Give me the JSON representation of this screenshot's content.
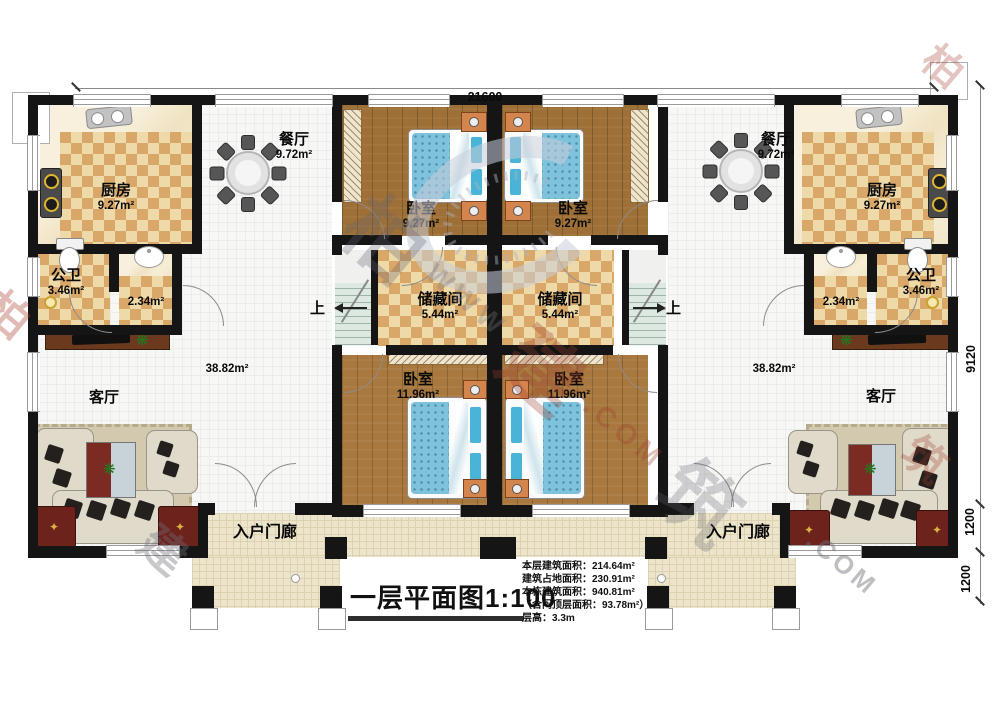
{
  "dims": {
    "top": "21600",
    "right_main": "9120",
    "right_mid": "1200",
    "right_low": "1200"
  },
  "stairs": {
    "up_left": "上",
    "up_right": "上"
  },
  "rooms": {
    "kitchen_left": {
      "name": "厨房",
      "area": "9.27m²"
    },
    "kitchen_right": {
      "name": "厨房",
      "area": "9.27m²"
    },
    "dining_left": {
      "name": "餐厅",
      "area": "9.72m²"
    },
    "dining_right": {
      "name": "餐厅",
      "area": "9.72m²"
    },
    "bath_left": {
      "name": "公卫",
      "area": "3.46m²"
    },
    "bath_right": {
      "name": "公卫",
      "area": "3.46m²"
    },
    "wash_left": {
      "area": "2.34m²"
    },
    "wash_right": {
      "area": "2.34m²"
    },
    "living_left": {
      "name": "客厅",
      "area": "38.82m²"
    },
    "living_right": {
      "name": "客厅",
      "area": "38.82m²"
    },
    "bedroom_top_left": {
      "name": "卧室",
      "area": "9.27m²"
    },
    "bedroom_top_right": {
      "name": "卧室",
      "area": "9.27m²"
    },
    "storage_left": {
      "name": "储藏间",
      "area": "5.44m²"
    },
    "storage_right": {
      "name": "储藏间",
      "area": "5.44m²"
    },
    "bedroom_bottom_left": {
      "name": "卧室",
      "area": "11.96m²"
    },
    "bedroom_bottom_right": {
      "name": "卧室",
      "area": "11.96m²"
    },
    "porch_left": {
      "name": "入户门廊"
    },
    "porch_right": {
      "name": "入户门廊"
    }
  },
  "title_block": {
    "title": "一层平面图1:100",
    "stats": {
      "line1": "本层建筑面积：214.64m²",
      "line2": "建筑占地面积：230.91m²",
      "line3": "本栋建筑面积：940.81m²",
      "line4": "（含闷顶层面积：93.78m²）",
      "line5": "层高：3.3m"
    }
  },
  "watermark": {
    "c1": "柏",
    "c2": "建",
    "c3": "筑",
    "www": "WWW",
    "com": ".COM"
  },
  "colors": {
    "wall": "#151515",
    "wood_floor": "#9e6f36",
    "checker_light": "#eed9a9",
    "checker_dark": "#d9a868",
    "bed_blue": "#7ec2dc",
    "nightstand_orange": "#d4854e",
    "porch_tile": "#ece4cb",
    "stair_green": "#dde8e1",
    "tile_white": "#f7f7f5",
    "table_red": "#7c2b22"
  }
}
